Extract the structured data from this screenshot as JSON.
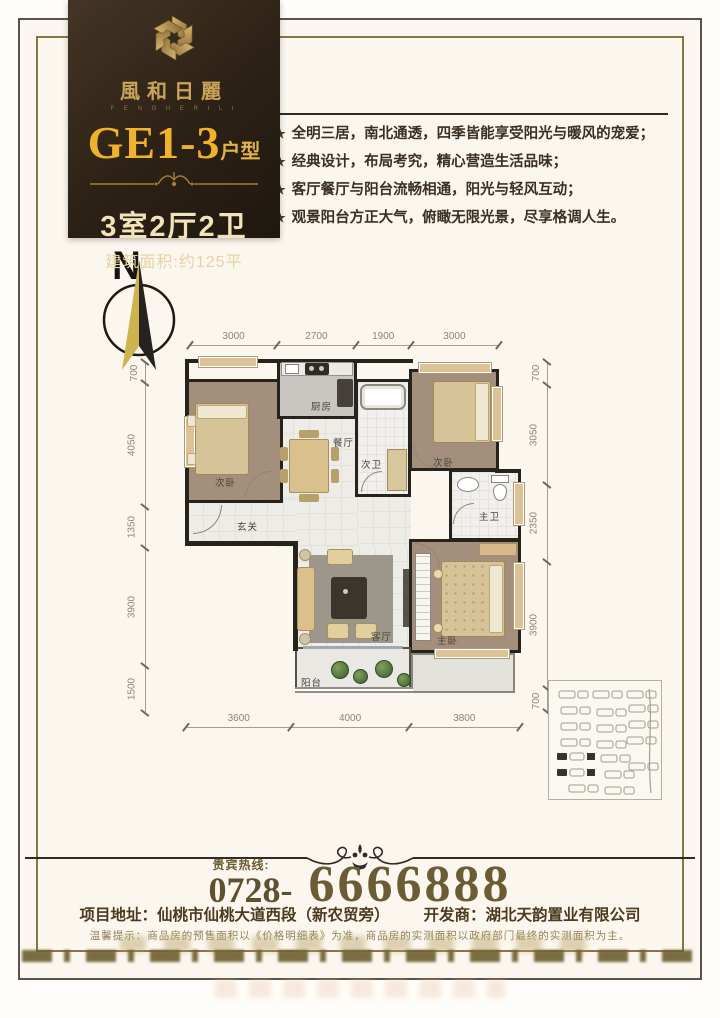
{
  "header": {
    "brand": "風和日麗",
    "brand_sub": "F E N G H E R I L I",
    "title": "GE1-3",
    "title_suffix": "户型",
    "spec": "3室2厅2卫",
    "area_label": "建筑面积:约125平"
  },
  "features": {
    "star": "★",
    "items": [
      "全明三居，南北通透，四季皆能享受阳光与暖风的宠爱；",
      "经典设计，布局考究，精心营造生活品味；",
      "客厅餐厅与阳台流畅相通，阳光与轻风互动；",
      "观景阳台方正大气，俯瞰无限光景，尽享格调人生。"
    ]
  },
  "compass": {
    "north_label": "N"
  },
  "plan": {
    "rooms": {
      "bedroom_left": "次卧",
      "kitchen": "厨房",
      "dining": "餐厅",
      "bath_second": "次卫",
      "bedroom_right": "次卧",
      "bath_master": "主卫",
      "entry": "玄关",
      "living": "客厅",
      "bedroom_master": "主卧",
      "balcony": "阳台"
    },
    "dims": {
      "top": [
        3000,
        2700,
        1900,
        3000
      ],
      "bottom": [
        3600,
        4000,
        3800
      ],
      "left": [
        700,
        4050,
        1350,
        3900,
        1500
      ],
      "right": [
        700,
        3050,
        2350,
        3900,
        700
      ]
    }
  },
  "hotline": {
    "label": "贵宾热线:",
    "prefix": "0728-",
    "number": "6666888"
  },
  "footer": {
    "address_label": "项目地址：",
    "address": "仙桃市仙桃大道西段（新农贸旁）",
    "developer_label": "开发商：",
    "developer": "湖北天韵置业有限公司",
    "disclaimer": "温馨提示：商品房的预售面积以《价格明细表》为准，商品房的实测面积以政府部门最终的实测面积为主。"
  },
  "colors": {
    "gold": "#f0b12b",
    "dark_brown": "#2c2115",
    "paper": "#fcf7ee",
    "wall": "#26221c"
  }
}
